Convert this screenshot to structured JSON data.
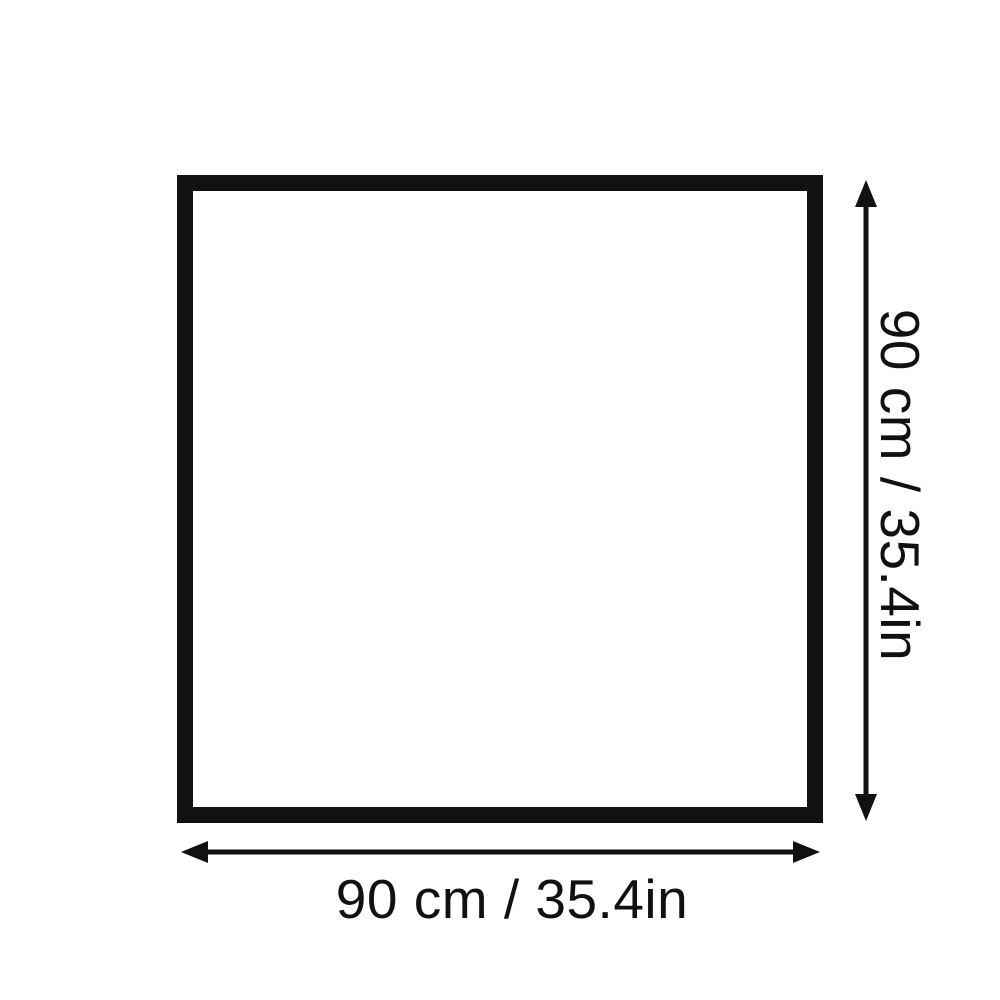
{
  "figure": {
    "type": "dimension-diagram",
    "shape": "square",
    "width_label": "90 cm / 35.4in",
    "height_label": "90 cm / 35.4in",
    "width_value_cm": 90,
    "width_value_in": 35.4,
    "height_value_cm": 90,
    "height_value_in": 35.4,
    "colors": {
      "line": "#111111",
      "background": "#ffffff",
      "square_fill": "#ffffff"
    }
  }
}
